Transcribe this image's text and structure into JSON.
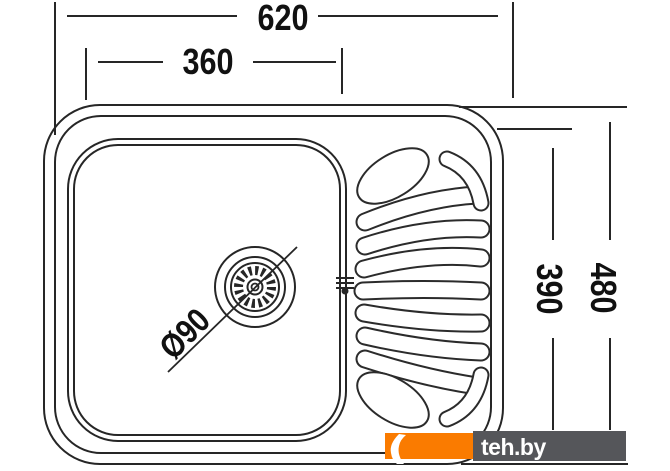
{
  "drawing": {
    "type": "kitchen-sink-top-view-technical-drawing",
    "dimensions": {
      "total_width": "620",
      "bowl_width": "360",
      "total_depth": "480",
      "bowl_depth": "390",
      "drain_diameter": "Ø90"
    }
  },
  "watermark": {
    "text": "teh.by",
    "orange_color": "#FA7B00",
    "gray_color": "#55565A"
  },
  "colors": {
    "line": "#262626",
    "label_text": "#111111",
    "background": "#ffffff"
  }
}
